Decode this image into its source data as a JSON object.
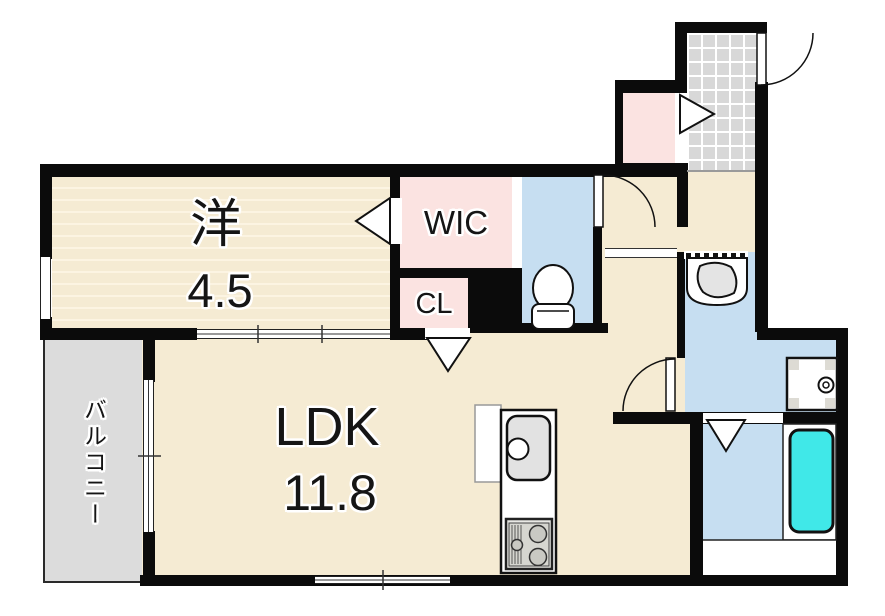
{
  "document": {
    "type": "apartment-floor-plan"
  },
  "rooms": {
    "western": {
      "name": "洋",
      "area": "4.5"
    },
    "wic": {
      "name": "WIC"
    },
    "cl": {
      "name": "CL"
    },
    "ldk": {
      "name": "LDK",
      "area": "11.8"
    },
    "balcony": {
      "name": "バルコニー"
    }
  },
  "fixtures": [
    "toilet",
    "washbasin",
    "washing-machine-pan",
    "kitchen-sink",
    "gas-stove",
    "bathtub",
    "refrigerator-space",
    "entrance-door",
    "hinged-doors",
    "sliding-doors",
    "windows",
    "closet-door-triangles"
  ],
  "colors": {
    "wall": "#0b0b0b",
    "floor_cream": "#f5ebd3",
    "floor_pink": "#fbe3e1",
    "floor_blue": "#c6def1",
    "tile_gray": "#d8d8d8",
    "balcony_gray": "#dcdcdc",
    "tub_cyan": "#40e8e8",
    "stripe_light": "#fcf4e2"
  }
}
